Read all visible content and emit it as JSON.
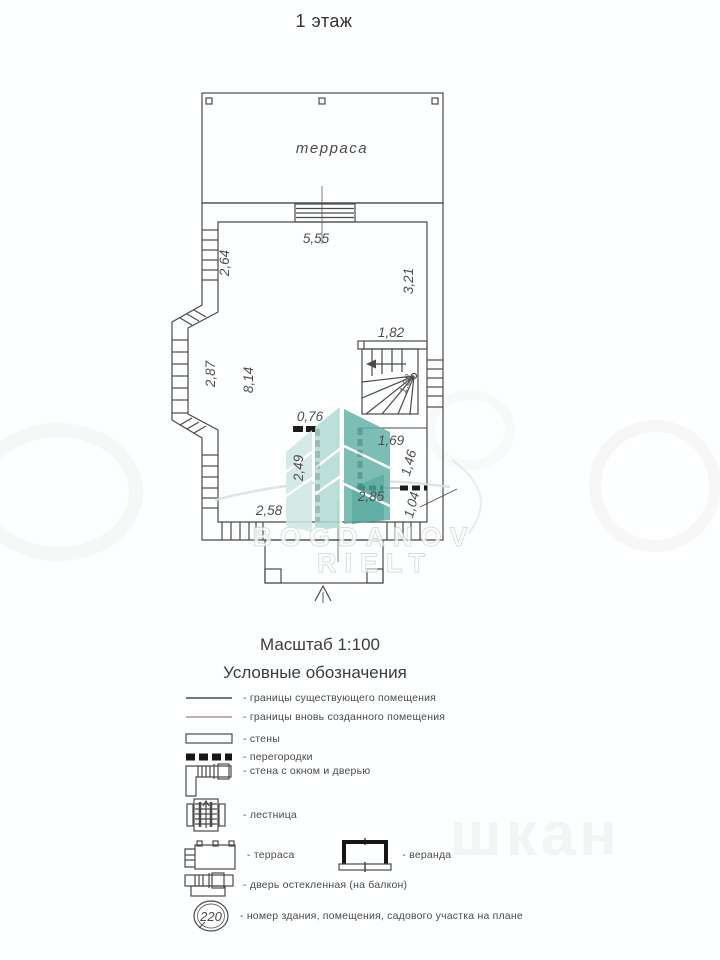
{
  "title": "1 этаж",
  "plan": {
    "terrace_label": "терраса",
    "dims": {
      "top_width": "5,55",
      "left_upper": "2,64",
      "right_wall": "3,21",
      "stair_opening": "1,82",
      "bay_window": "2,87",
      "room_depth": "8,14",
      "partition_stub": "0,76",
      "partition_len": "2,49",
      "bath_width": "1,69",
      "bath_depth": "1,46",
      "bath_bottom": "2,85",
      "bath_niche": "1,04",
      "bottom_left": "2,58",
      "stair_turn": "1,88"
    }
  },
  "watermark": {
    "line1": "BOGDANOV",
    "line2": "RIELT",
    "fragment": "шкан",
    "colors": {
      "teal_light": "#cfe7e3",
      "teal_mid": "#b0dad3",
      "teal_dark": "#66b3a9",
      "teal_deep": "#48a296"
    }
  },
  "scale_label": "Масштаб 1:100",
  "legend": {
    "title": "Условные обозначения",
    "badge": "220",
    "colors": {
      "existing_line": "#4a4a4a",
      "new_line": "#b58f8f"
    },
    "items": [
      {
        "label": "- границы существующего помещения"
      },
      {
        "label": "- границы вновь созданного помещения"
      },
      {
        "label": "- стены"
      },
      {
        "label": "- перегородки"
      },
      {
        "label": "- стена с окном и дверью"
      },
      {
        "label": "- лестница"
      },
      {
        "label": "- терраса"
      },
      {
        "label": "- веранда"
      },
      {
        "label": "- дверь остекленная (на балкон)"
      },
      {
        "label": "- номер здания, помещения, садового участка на плане"
      }
    ]
  }
}
